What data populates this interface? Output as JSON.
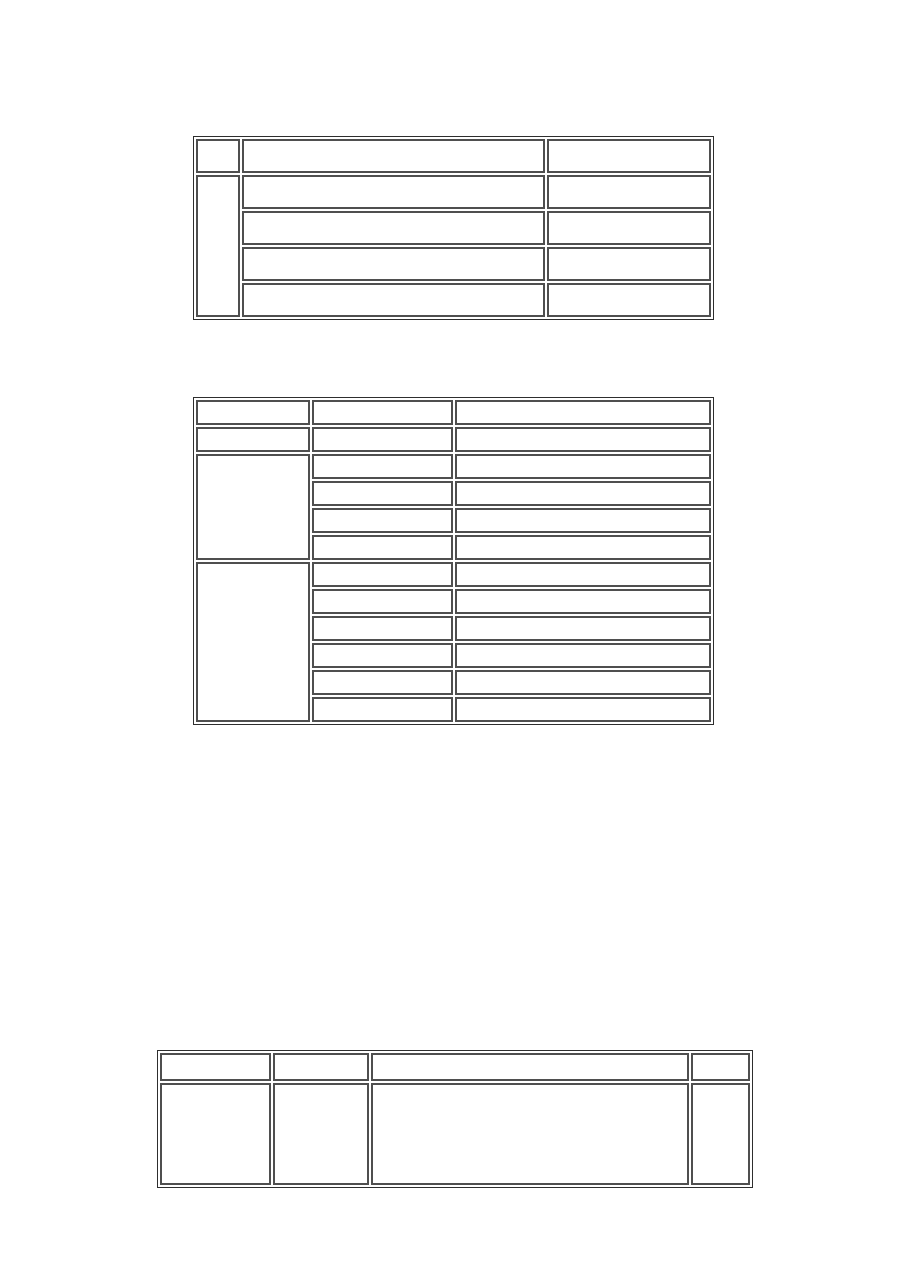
{
  "page": {
    "background_color": "#ffffff",
    "description": "Blank document page with three empty tables"
  },
  "colors": {
    "table_frame": "#2e2e2e",
    "cell_border": "#4f4f4f",
    "cell_background": "#ffffff"
  },
  "tables": {
    "table1": {
      "title": "",
      "column_count": 3,
      "rows": [
        [
          "",
          "",
          ""
        ],
        [
          "",
          "",
          ""
        ],
        [
          "",
          ""
        ],
        [
          "",
          ""
        ],
        [
          "",
          ""
        ]
      ]
    },
    "table2": {
      "title": "",
      "column_count": 3,
      "rows": [
        [
          "",
          "",
          ""
        ],
        [
          "",
          "",
          ""
        ],
        [
          "",
          "",
          ""
        ],
        [
          "",
          ""
        ],
        [
          "",
          ""
        ],
        [
          "",
          ""
        ],
        [
          "",
          "",
          ""
        ],
        [
          "",
          ""
        ],
        [
          "",
          ""
        ],
        [
          "",
          ""
        ],
        [
          "",
          ""
        ],
        [
          "",
          ""
        ]
      ]
    },
    "table3": {
      "title": "",
      "column_count": 4,
      "rows": [
        [
          "",
          "",
          "",
          ""
        ],
        [
          "",
          "",
          "",
          ""
        ]
      ]
    }
  }
}
